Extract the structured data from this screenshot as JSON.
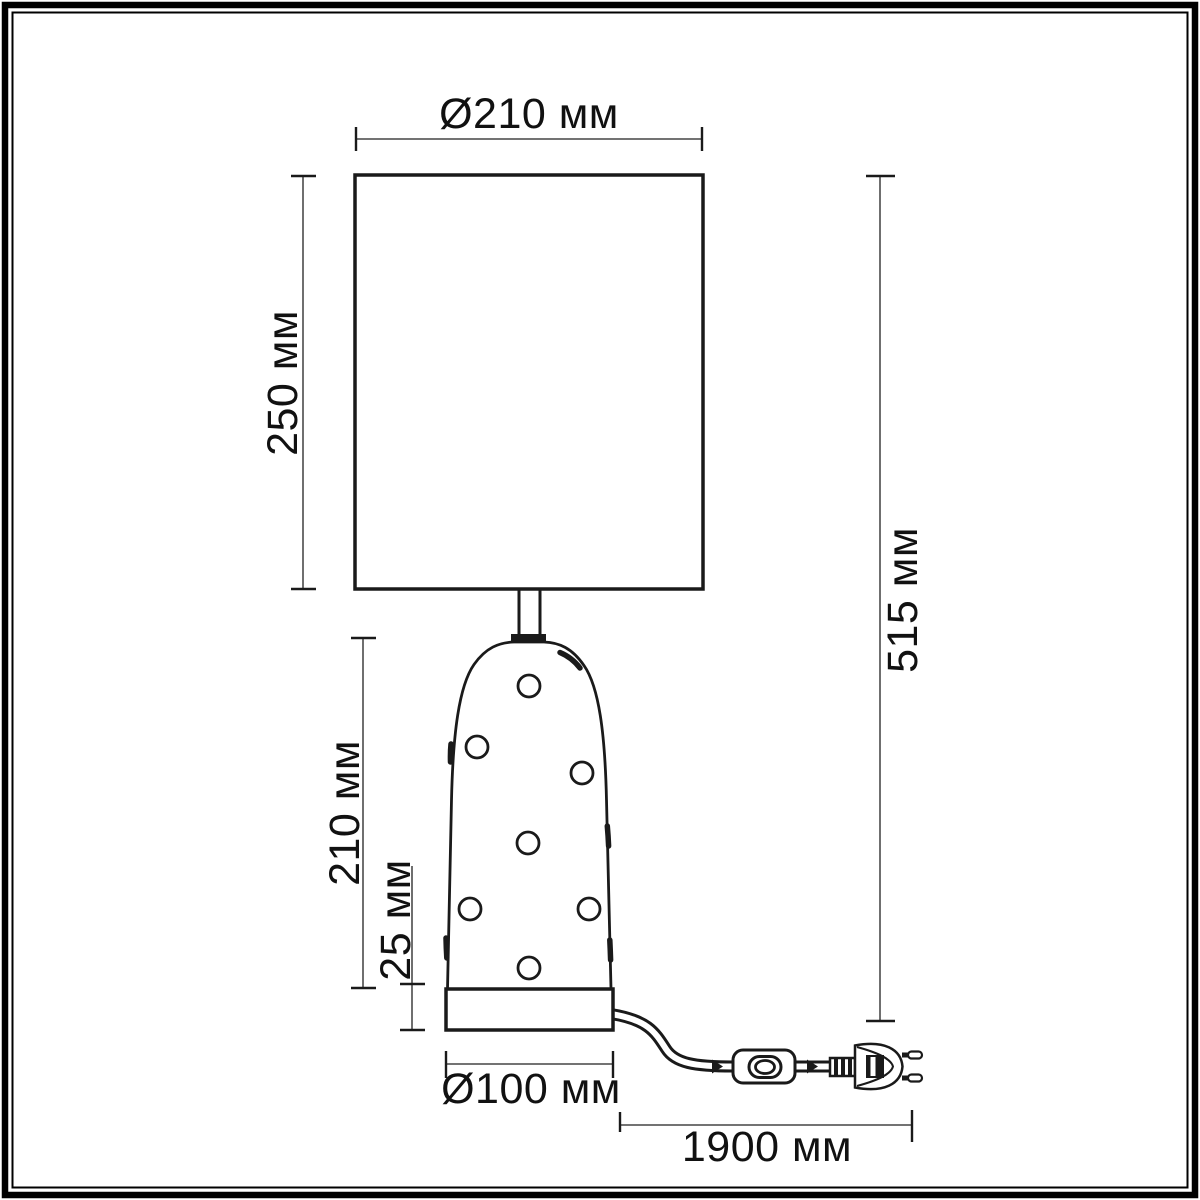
{
  "canvas": {
    "width_px": 1200,
    "height_px": 1200,
    "background": "#ffffff"
  },
  "frame": {
    "outer_border_color": "#000000",
    "inner_border_color": "#000000"
  },
  "colors": {
    "drawing_line": "#1a1a1a",
    "dimension_line": "#5f5f5f",
    "dimension_tick": "#1a1a1a",
    "text": "#111111"
  },
  "dims": {
    "shade_diameter": "Ø210 мм",
    "shade_height": "250 мм",
    "body_height": "210 мм",
    "base_height": "25 мм",
    "total_height": "515 мм",
    "base_diameter": "Ø100 мм",
    "cord_length": "1900 мм"
  },
  "parts": {
    "lampshade": "lampshade",
    "stem": "neck-stem",
    "body": "polka-dot-body",
    "base": "base-plinth",
    "cord": "power-cord",
    "switch": "inline-switch-icon",
    "plug": "euro-plug-icon"
  }
}
